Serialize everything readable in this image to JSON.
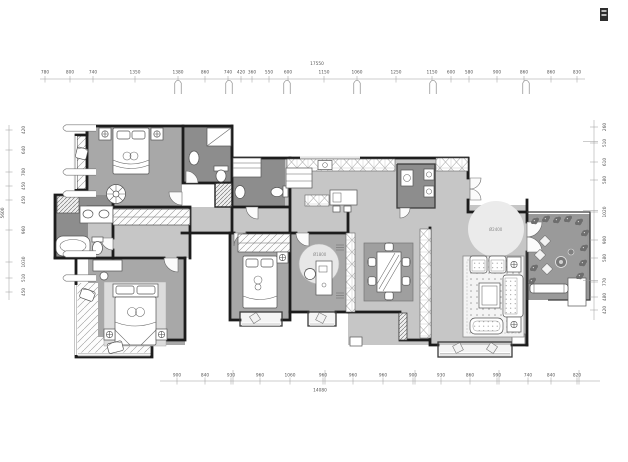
{
  "drawing": {
    "type": "residential floor plan",
    "colors": {
      "wall": "#1c1c1c",
      "floor_light": "#c6c6c6",
      "floor_medium": "#a8a8a8",
      "floor_dark": "#8d8d8d",
      "terrace": "#9a9a9a"
    }
  },
  "labels": {
    "entry_rug": "Ø2400",
    "study_rug": "Ø1800"
  },
  "dims": {
    "top": {
      "overall": "17550",
      "xs": [
        45,
        70,
        93,
        135,
        178,
        205,
        228,
        241,
        252,
        269,
        288,
        324,
        357,
        396,
        432,
        451,
        469,
        497,
        524,
        551,
        577
      ],
      "labels": [
        "780",
        "800",
        "740",
        "1350",
        "1380",
        "860",
        "740",
        "420",
        "360",
        "550",
        "600",
        "1150",
        "1060",
        "1250",
        "1150",
        "600",
        "580",
        "900",
        "860",
        "860",
        "830"
      ],
      "brackets": [
        178,
        229,
        287,
        357,
        433,
        526
      ]
    },
    "bottom": {
      "overall": "14080",
      "xs": [
        177,
        205,
        231,
        260,
        290,
        323,
        353,
        383,
        413,
        441,
        470,
        497,
        528,
        551,
        577
      ],
      "labels": [
        "900",
        "840",
        "930",
        "960",
        "1060",
        "960",
        "960",
        "960",
        "900",
        "930",
        "860",
        "990",
        "740",
        "840",
        "820"
      ]
    },
    "left": {
      "overall": "5600",
      "ys": [
        130,
        150,
        172,
        186,
        200,
        230,
        262,
        278,
        292
      ],
      "labels": [
        "420",
        "640",
        "700",
        "450",
        "450",
        "960",
        "1030",
        "510",
        "450"
      ],
      "brackets": [
        128,
        172,
        194,
        254,
        278
      ]
    },
    "right": {
      "ys": [
        127,
        143,
        162,
        180,
        212,
        240,
        258,
        282,
        297,
        310
      ],
      "labels": [
        "260",
        "510",
        "610",
        "580",
        "1020",
        "900",
        "580",
        "770",
        "480",
        "420"
      ]
    }
  }
}
